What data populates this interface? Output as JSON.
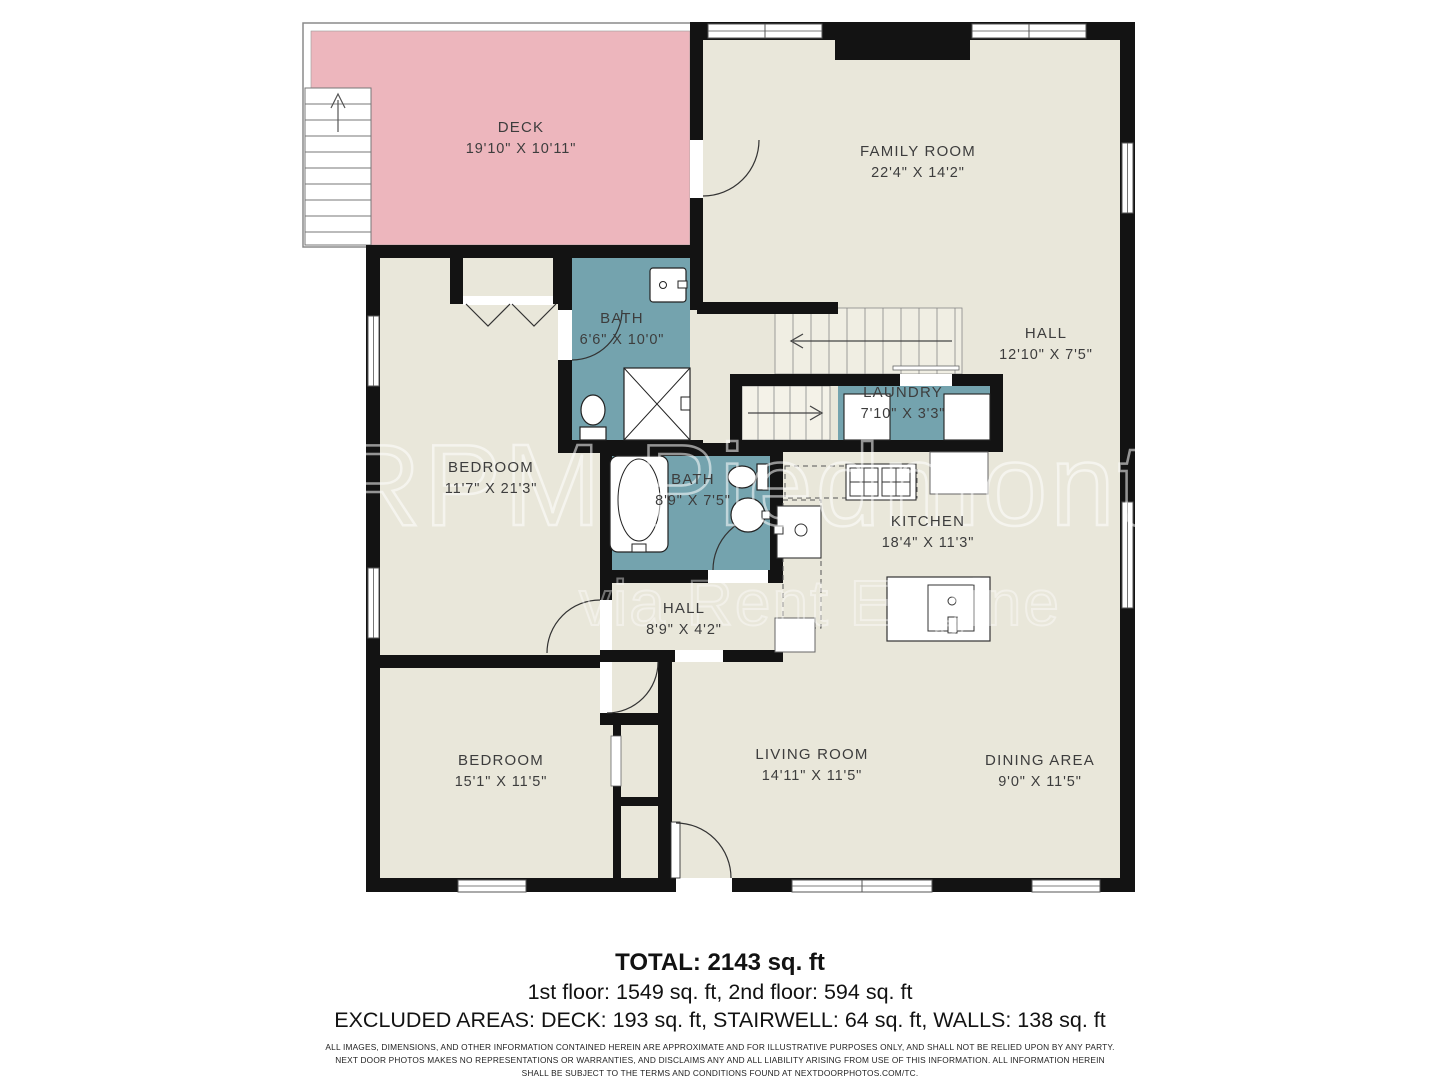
{
  "plan": {
    "rooms": [
      {
        "id": "deck",
        "name": "DECK",
        "dims": "19'10\" X 10'11\"",
        "x": 521,
        "y": 119
      },
      {
        "id": "family-room",
        "name": "FAMILY ROOM",
        "dims": "22'4\" X 14'2\"",
        "x": 918,
        "y": 143
      },
      {
        "id": "bath-upper",
        "name": "BATH",
        "dims": "6'6\" X 10'0\"",
        "x": 622,
        "y": 310
      },
      {
        "id": "hall-upper",
        "name": "HALL",
        "dims": "12'10\" X 7'5\"",
        "x": 1046,
        "y": 325
      },
      {
        "id": "laundry",
        "name": "LAUNDRY",
        "dims": "7'10\" X 3'3\"",
        "x": 903,
        "y": 384
      },
      {
        "id": "bedroom-1",
        "name": "BEDROOM",
        "dims": "11'7\" X 21'3\"",
        "x": 491,
        "y": 459
      },
      {
        "id": "bath-main",
        "name": "BATH",
        "dims": "8'9\" X 7'5\"",
        "x": 693,
        "y": 471
      },
      {
        "id": "kitchen",
        "name": "KITCHEN",
        "dims": "18'4\" X 11'3\"",
        "x": 928,
        "y": 513
      },
      {
        "id": "hall-lower",
        "name": "HALL",
        "dims": "8'9\" X 4'2\"",
        "x": 684,
        "y": 600
      },
      {
        "id": "bedroom-2",
        "name": "BEDROOM",
        "dims": "15'1\" X 11'5\"",
        "x": 501,
        "y": 752
      },
      {
        "id": "living-room",
        "name": "LIVING ROOM",
        "dims": "14'11\" X 11'5\"",
        "x": 812,
        "y": 746
      },
      {
        "id": "dining-area",
        "name": "DINING AREA",
        "dims": "9'0\" X 11'5\"",
        "x": 1040,
        "y": 752
      }
    ]
  },
  "watermark": {
    "primary": "RPM Piedmont",
    "secondary": "via Rent Engine"
  },
  "summary": {
    "total": "TOTAL: 2143 sq. ft",
    "floors": "1st floor: 1549 sq. ft, 2nd floor: 594 sq. ft",
    "excluded": "EXCLUDED AREAS: DECK: 193 sq. ft, STAIRWELL: 64 sq. ft, WALLS: 138 sq. ft"
  },
  "disclaimer": [
    "ALL IMAGES, DIMENSIONS, AND OTHER INFORMATION CONTAINED HEREIN ARE APPROXIMATE AND FOR ILLUSTRATIVE PURPOSES ONLY, AND SHALL NOT BE RELIED UPON BY ANY PARTY.",
    "NEXT DOOR PHOTOS MAKES NO REPRESENTATIONS OR WARRANTIES, AND DISCLAIMS ANY AND ALL LIABILITY ARISING FROM USE OF THIS INFORMATION. ALL INFORMATION HEREIN",
    "SHALL BE SUBJECT TO THE TERMS AND CONDITIONS FOUND AT NEXTDOORPHOTOS.COM/TC."
  ],
  "colors": {
    "room_fill": "#e9e7da",
    "bath_fill": "#74a3ae",
    "deck_fill": "#edb6bd",
    "wall": "#131313",
    "label_text": "#3d3d3d"
  }
}
